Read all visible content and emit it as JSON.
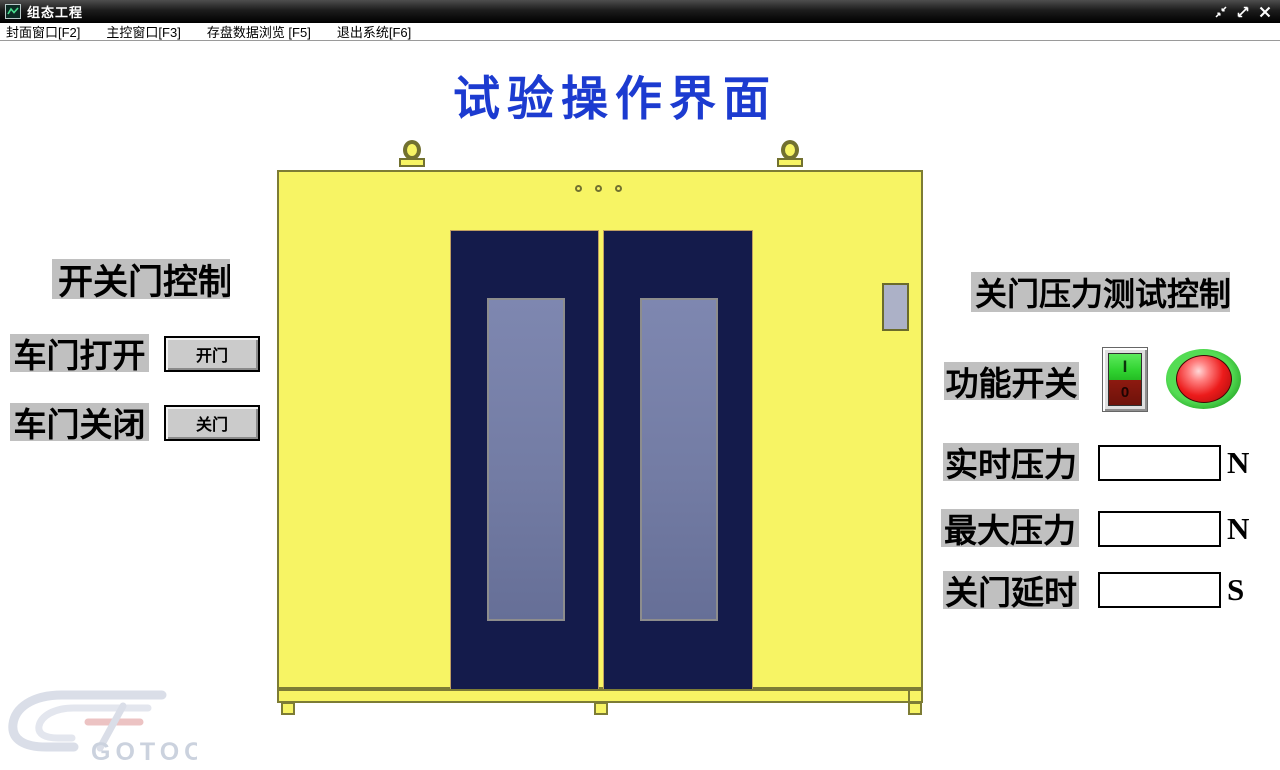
{
  "window": {
    "title": "组态工程"
  },
  "menu": {
    "items": [
      {
        "label": "封面窗口[F2]"
      },
      {
        "label": "主控窗口[F3]"
      },
      {
        "label": "存盘数据浏览 [F5]"
      },
      {
        "label": "退出系统[F6]"
      }
    ]
  },
  "page": {
    "title": "试验操作界面"
  },
  "door_control": {
    "section_title": "开关门控制",
    "rows": [
      {
        "label": "车门打开",
        "button_label": "开门"
      },
      {
        "label": "车门关闭",
        "button_label": "关门"
      }
    ]
  },
  "pressure_test": {
    "section_title": "关门压力测试控制",
    "function_switch_label": "功能开关",
    "switch_on_mark": "I",
    "switch_off_mark": "0",
    "fields": [
      {
        "label": "实时压力",
        "value": "",
        "unit": "N"
      },
      {
        "label": "最大压力",
        "value": "",
        "unit": "N"
      },
      {
        "label": "关门延时",
        "value": "",
        "unit": "S"
      }
    ]
  },
  "watermark": {
    "text": "GOTOO"
  },
  "colors": {
    "title_blue": "#1c3bd0",
    "chamber_yellow": "#f7f464",
    "chamber_border_olive": "#7d7c35",
    "door_navy": "#141b4b",
    "door_glass": "#737ca4",
    "label_gray": "#c0c0c0",
    "switch_green": "#32d432",
    "switch_red": "#7d150d",
    "lamp_ring_green": "#3bcf3b",
    "lamp_red": "#e31212"
  }
}
